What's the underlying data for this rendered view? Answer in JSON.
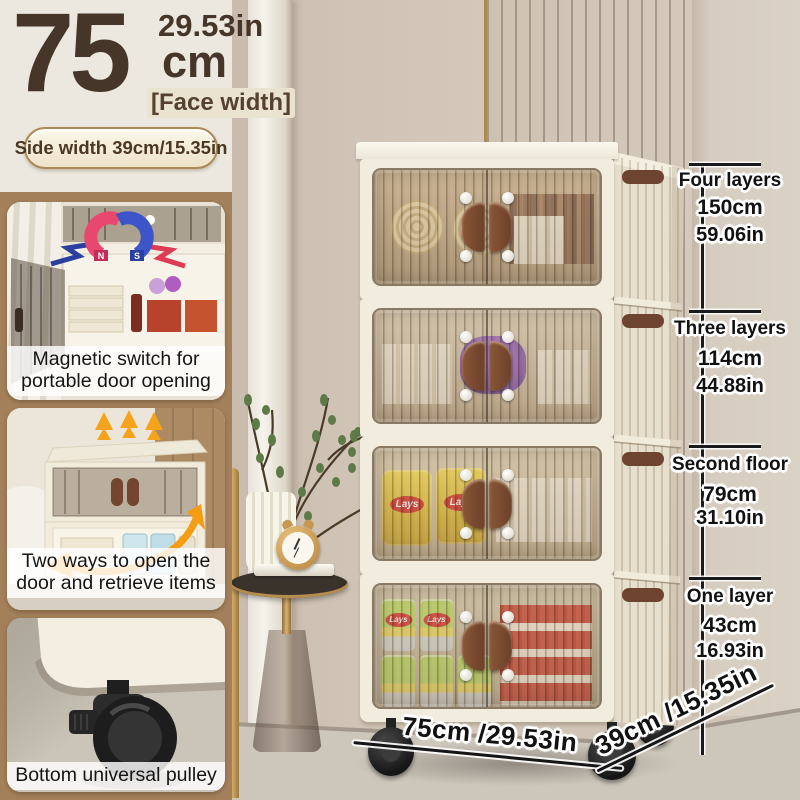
{
  "header": {
    "width_number": "75",
    "width_unit": "cm",
    "width_inches": "29.53in",
    "face_width_tag": "[Face width]",
    "side_width_pill": "Side width 39cm/15.35in"
  },
  "insets": [
    {
      "caption_line1": "Magnetic switch for",
      "caption_line2": "portable door opening",
      "magnet_north": "N",
      "magnet_south": "S"
    },
    {
      "caption_line1": "Two ways to open the",
      "caption_line2": "door and retrieve items"
    },
    {
      "caption_line1": "Bottom universal pulley"
    }
  ],
  "measurements": {
    "segments": [
      {
        "label": "Four layers",
        "cm": "150cm",
        "inches": "59.06in"
      },
      {
        "label": "Three layers",
        "cm": "114cm",
        "inches": "44.88in"
      },
      {
        "label": "Second floor",
        "cm": "79cm",
        "inches": "31.10in"
      },
      {
        "label": "One layer",
        "cm": "43cm",
        "inches": "16.93in"
      }
    ],
    "bottom_width": "75cm /29.53in",
    "bottom_depth": "39cm /15.35in"
  },
  "product": {
    "snack_brand": "Lays"
  },
  "colors": {
    "accent_brown": "#453629",
    "panel_tan": "#a3805a",
    "cabinet_cream": "#f1ecdd",
    "handle_brown": "#6b4028",
    "arrow_orange": "#f5a31c",
    "magnet_red": "#e8486d",
    "magnet_blue": "#3d55c9"
  }
}
